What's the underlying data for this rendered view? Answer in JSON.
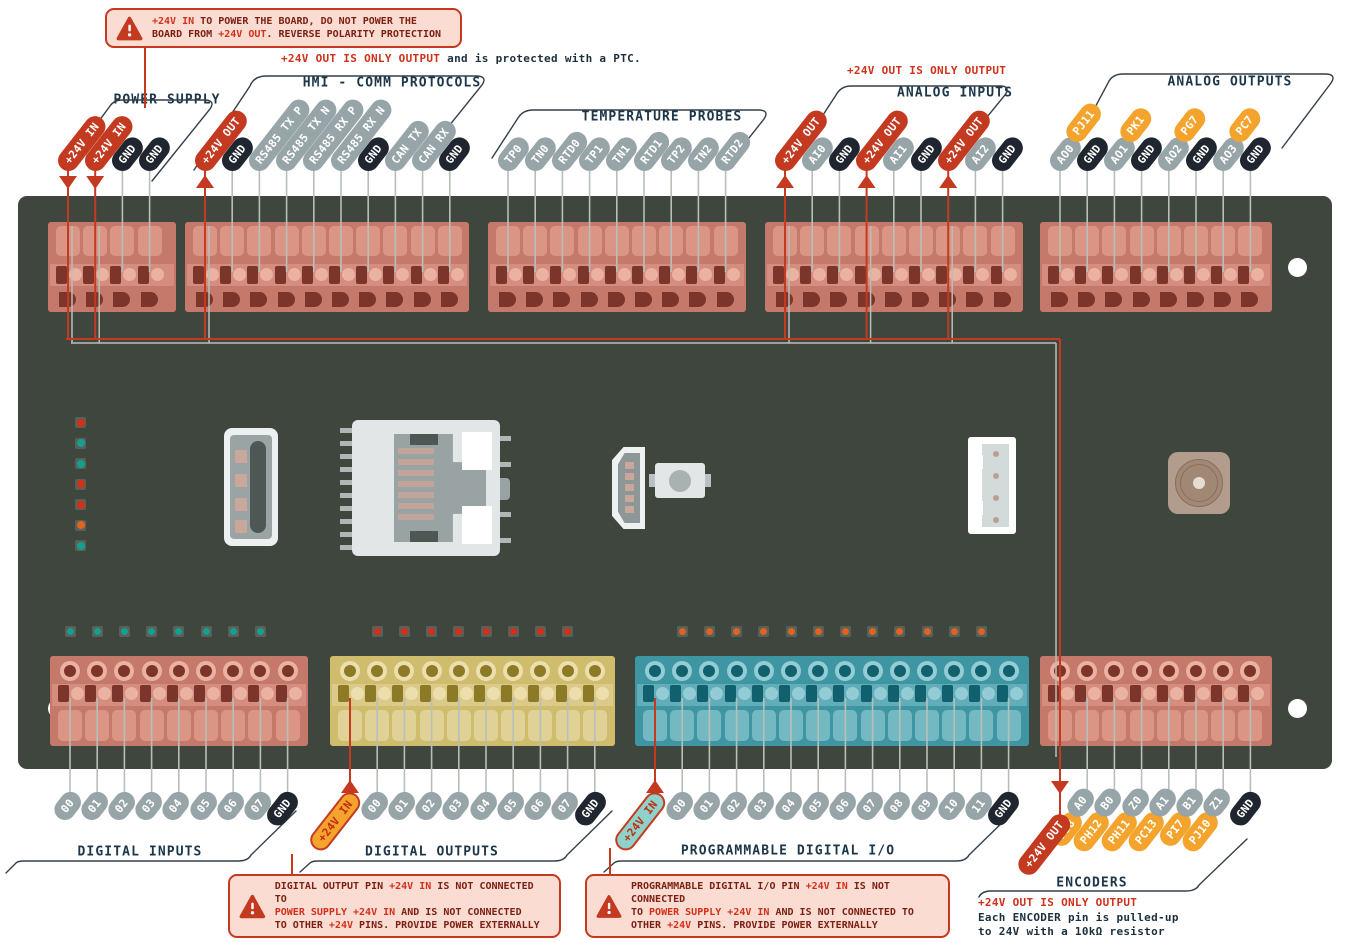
{
  "colors": {
    "board": "#3e463e",
    "accent_red": "#c43a20",
    "bright_red": "#d2301a",
    "pin_gray": "#97a5a9",
    "pin_dark": "#20262f",
    "pin_orange": "#f4a42c",
    "title_navy": "#1c3649",
    "warn_bg": "#fbdcd2",
    "led_teal": "#14a08e",
    "led_red": "#d23018",
    "led_orange": "#e0641f"
  },
  "warnings": {
    "top": {
      "segments": [
        {
          "t": "+24V IN",
          "c": "red"
        },
        {
          "t": " TO POWER THE BOARD, DO NOT POWER THE",
          "c": "dark"
        },
        {
          "br": true
        },
        {
          "t": "BOARD FROM ",
          "c": "dark"
        },
        {
          "t": "+24V OUT",
          "c": "red"
        },
        {
          "t": ". REVERSE POLARITY PROTECTION",
          "c": "dark"
        }
      ]
    },
    "digital_outputs": {
      "segments": [
        {
          "t": "DIGITAL OUTPUT PIN ",
          "c": "dark"
        },
        {
          "t": "+24V IN",
          "c": "red"
        },
        {
          "t": " IS NOT CONNECTED TO",
          "c": "dark"
        },
        {
          "br": true
        },
        {
          "t": "POWER SUPPLY +24V IN",
          "c": "red"
        },
        {
          "t": " AND IS NOT CONNECTED",
          "c": "dark"
        },
        {
          "br": true
        },
        {
          "t": "TO OTHER ",
          "c": "dark"
        },
        {
          "t": "+24V",
          "c": "red"
        },
        {
          "t": " PINS. PROVIDE POWER EXTERNALLY",
          "c": "dark"
        }
      ]
    },
    "programmable": {
      "segments": [
        {
          "t": "PROGRAMMABLE DIGITAL I/O PIN ",
          "c": "dark"
        },
        {
          "t": "+24V IN",
          "c": "red"
        },
        {
          "t": " IS NOT CONNECTED",
          "c": "dark"
        },
        {
          "br": true
        },
        {
          "t": "TO ",
          "c": "dark"
        },
        {
          "t": "POWER SUPPLY +24V IN",
          "c": "red"
        },
        {
          "t": " AND IS NOT CONNECTED TO",
          "c": "dark"
        },
        {
          "br": true
        },
        {
          "t": "OTHER ",
          "c": "dark"
        },
        {
          "t": "+24V",
          "c": "red"
        },
        {
          "t": " PINS. PROVIDE POWER EXTERNALLY",
          "c": "dark"
        }
      ]
    }
  },
  "notes": {
    "ptc": {
      "segments": [
        {
          "t": "+24V OUT IS ONLY OUTPUT",
          "c": "red"
        },
        {
          "t": " and is protected with a PTC.",
          "c": "navy"
        }
      ]
    },
    "analog": {
      "segments": [
        {
          "t": "+24V OUT IS ONLY OUTPUT",
          "c": "red"
        }
      ]
    },
    "encoders": {
      "segments": [
        {
          "t": "+24V OUT IS ONLY OUTPUT",
          "c": "red"
        },
        {
          "br": true
        },
        {
          "t": "Each ENCODER pin is pulled-up",
          "c": "navy"
        },
        {
          "br": true
        },
        {
          "t": "to 24V with a 10kΩ resistor",
          "c": "navy"
        }
      ]
    }
  },
  "groups": [
    {
      "title": "POWER SUPPLY",
      "pins": [
        {
          "label": "+24V IN",
          "style": "red",
          "arrow": "down",
          "routed": true
        },
        {
          "label": "+24V IN",
          "style": "red",
          "arrow": "down",
          "routed": true
        },
        {
          "label": "GND",
          "style": "dark"
        },
        {
          "label": "GND",
          "style": "dark"
        }
      ]
    },
    {
      "title": "HMI - COMM PROTOCOLS",
      "pins": [
        {
          "label": "+24V OUT",
          "style": "red",
          "arrow": "up",
          "routed": true
        },
        {
          "label": "GND",
          "style": "dark"
        },
        {
          "label": "RS485 TX P",
          "style": "gray"
        },
        {
          "label": "RS485 TX N",
          "style": "gray"
        },
        {
          "label": "RS485 RX P",
          "style": "gray"
        },
        {
          "label": "RS485 RX N",
          "style": "gray"
        },
        {
          "label": "GND",
          "style": "dark"
        },
        {
          "label": "CAN TX",
          "style": "gray"
        },
        {
          "label": "CAN RX",
          "style": "gray"
        },
        {
          "label": "GND",
          "style": "dark"
        }
      ]
    },
    {
      "title": "TEMPERATURE PROBES",
      "pins": [
        {
          "label": "TP0",
          "style": "gray"
        },
        {
          "label": "TN0",
          "style": "gray"
        },
        {
          "label": "RTD0",
          "style": "gray"
        },
        {
          "label": "TP1",
          "style": "gray"
        },
        {
          "label": "TN1",
          "style": "gray"
        },
        {
          "label": "RTD1",
          "style": "gray"
        },
        {
          "label": "TP2",
          "style": "gray"
        },
        {
          "label": "TN2",
          "style": "gray"
        },
        {
          "label": "RTD2",
          "style": "gray"
        }
      ]
    },
    {
      "title": "ANALOG INPUTS",
      "pins": [
        {
          "label": "+24V OUT",
          "style": "red",
          "arrow": "up",
          "routed": true
        },
        {
          "label": "AI0",
          "style": "gray"
        },
        {
          "label": "GND",
          "style": "dark"
        },
        {
          "label": "+24V OUT",
          "style": "red",
          "arrow": "up",
          "routed": true
        },
        {
          "label": "AI1",
          "style": "gray"
        },
        {
          "label": "GND",
          "style": "dark"
        },
        {
          "label": "+24V OUT",
          "style": "red",
          "arrow": "up",
          "routed": true
        },
        {
          "label": "AI2",
          "style": "gray"
        },
        {
          "label": "GND",
          "style": "dark"
        }
      ]
    },
    {
      "title": "ANALOG OUTPUTS",
      "pins": [
        {
          "segments": [
            {
              "label": "AO0",
              "style": "gray"
            },
            {
              "label": "PJ11",
              "style": "orange"
            }
          ]
        },
        {
          "label": "GND",
          "style": "dark"
        },
        {
          "segments": [
            {
              "label": "AO1",
              "style": "gray"
            },
            {
              "label": "PK1",
              "style": "orange"
            }
          ]
        },
        {
          "label": "GND",
          "style": "dark"
        },
        {
          "segments": [
            {
              "label": "AO2",
              "style": "gray"
            },
            {
              "label": "PG7",
              "style": "orange"
            }
          ]
        },
        {
          "label": "GND",
          "style": "dark"
        },
        {
          "segments": [
            {
              "label": "AO3",
              "style": "gray"
            },
            {
              "label": "PC7",
              "style": "orange"
            }
          ]
        },
        {
          "label": "GND",
          "style": "dark"
        }
      ]
    },
    {
      "title": "DIGITAL INPUTS",
      "pins": [
        {
          "label": "00",
          "style": "gray"
        },
        {
          "label": "01",
          "style": "gray"
        },
        {
          "label": "02",
          "style": "gray"
        },
        {
          "label": "03",
          "style": "gray"
        },
        {
          "label": "04",
          "style": "gray"
        },
        {
          "label": "05",
          "style": "gray"
        },
        {
          "label": "06",
          "style": "gray"
        },
        {
          "label": "07",
          "style": "gray"
        },
        {
          "label": "GND",
          "style": "dark"
        }
      ]
    },
    {
      "title": "DIGITAL OUTPUTS",
      "pins": [
        {
          "label": "+24V IN",
          "style": "orange-in",
          "arrow": "up"
        },
        {
          "label": "00",
          "style": "gray"
        },
        {
          "label": "01",
          "style": "gray"
        },
        {
          "label": "02",
          "style": "gray"
        },
        {
          "label": "03",
          "style": "gray"
        },
        {
          "label": "04",
          "style": "gray"
        },
        {
          "label": "05",
          "style": "gray"
        },
        {
          "label": "06",
          "style": "gray"
        },
        {
          "label": "07",
          "style": "gray"
        },
        {
          "label": "GND",
          "style": "dark"
        }
      ]
    },
    {
      "title": "PROGRAMMABLE DIGITAL I/O",
      "pins": [
        {
          "label": "+24V IN",
          "style": "teal-in",
          "arrow": "up"
        },
        {
          "label": "00",
          "style": "gray"
        },
        {
          "label": "01",
          "style": "gray"
        },
        {
          "label": "02",
          "style": "gray"
        },
        {
          "label": "03",
          "style": "gray"
        },
        {
          "label": "04",
          "style": "gray"
        },
        {
          "label": "05",
          "style": "gray"
        },
        {
          "label": "06",
          "style": "gray"
        },
        {
          "label": "07",
          "style": "gray"
        },
        {
          "label": "08",
          "style": "gray"
        },
        {
          "label": "09",
          "style": "gray"
        },
        {
          "label": "10",
          "style": "gray"
        },
        {
          "label": "11",
          "style": "gray"
        },
        {
          "label": "GND",
          "style": "dark"
        }
      ]
    },
    {
      "title": "ENCODERS",
      "pins": [
        {
          "label": "+24V OUT",
          "style": "red",
          "arrow": "down",
          "routed": true
        },
        {
          "segments": [
            {
              "label": "PJ8",
              "style": "orange"
            },
            {
              "label": "A0",
              "style": "gray"
            }
          ]
        },
        {
          "segments": [
            {
              "label": "PH12",
              "style": "orange"
            },
            {
              "label": "B0",
              "style": "gray"
            }
          ]
        },
        {
          "segments": [
            {
              "label": "PH11",
              "style": "orange"
            },
            {
              "label": "Z0",
              "style": "gray"
            }
          ]
        },
        {
          "segments": [
            {
              "label": "PC13",
              "style": "orange"
            },
            {
              "label": "A1",
              "style": "gray"
            }
          ]
        },
        {
          "segments": [
            {
              "label": "PI7",
              "style": "orange"
            },
            {
              "label": "B1",
              "style": "gray"
            }
          ]
        },
        {
          "segments": [
            {
              "label": "PJ10",
              "style": "orange"
            },
            {
              "label": "Z1",
              "style": "gray"
            }
          ]
        },
        {
          "label": "GND",
          "style": "dark"
        }
      ]
    }
  ],
  "board": {
    "status_leds": [
      "led_red",
      "led_teal",
      "led_teal",
      "led_red",
      "led_red",
      "led_orange",
      "led_teal"
    ],
    "digital_input_leds": {
      "count": 8,
      "color": "led_teal"
    },
    "digital_output_leds": {
      "count": 8,
      "color": "led_red"
    },
    "programmable_leds": {
      "count": 12,
      "color": "led_orange"
    }
  }
}
